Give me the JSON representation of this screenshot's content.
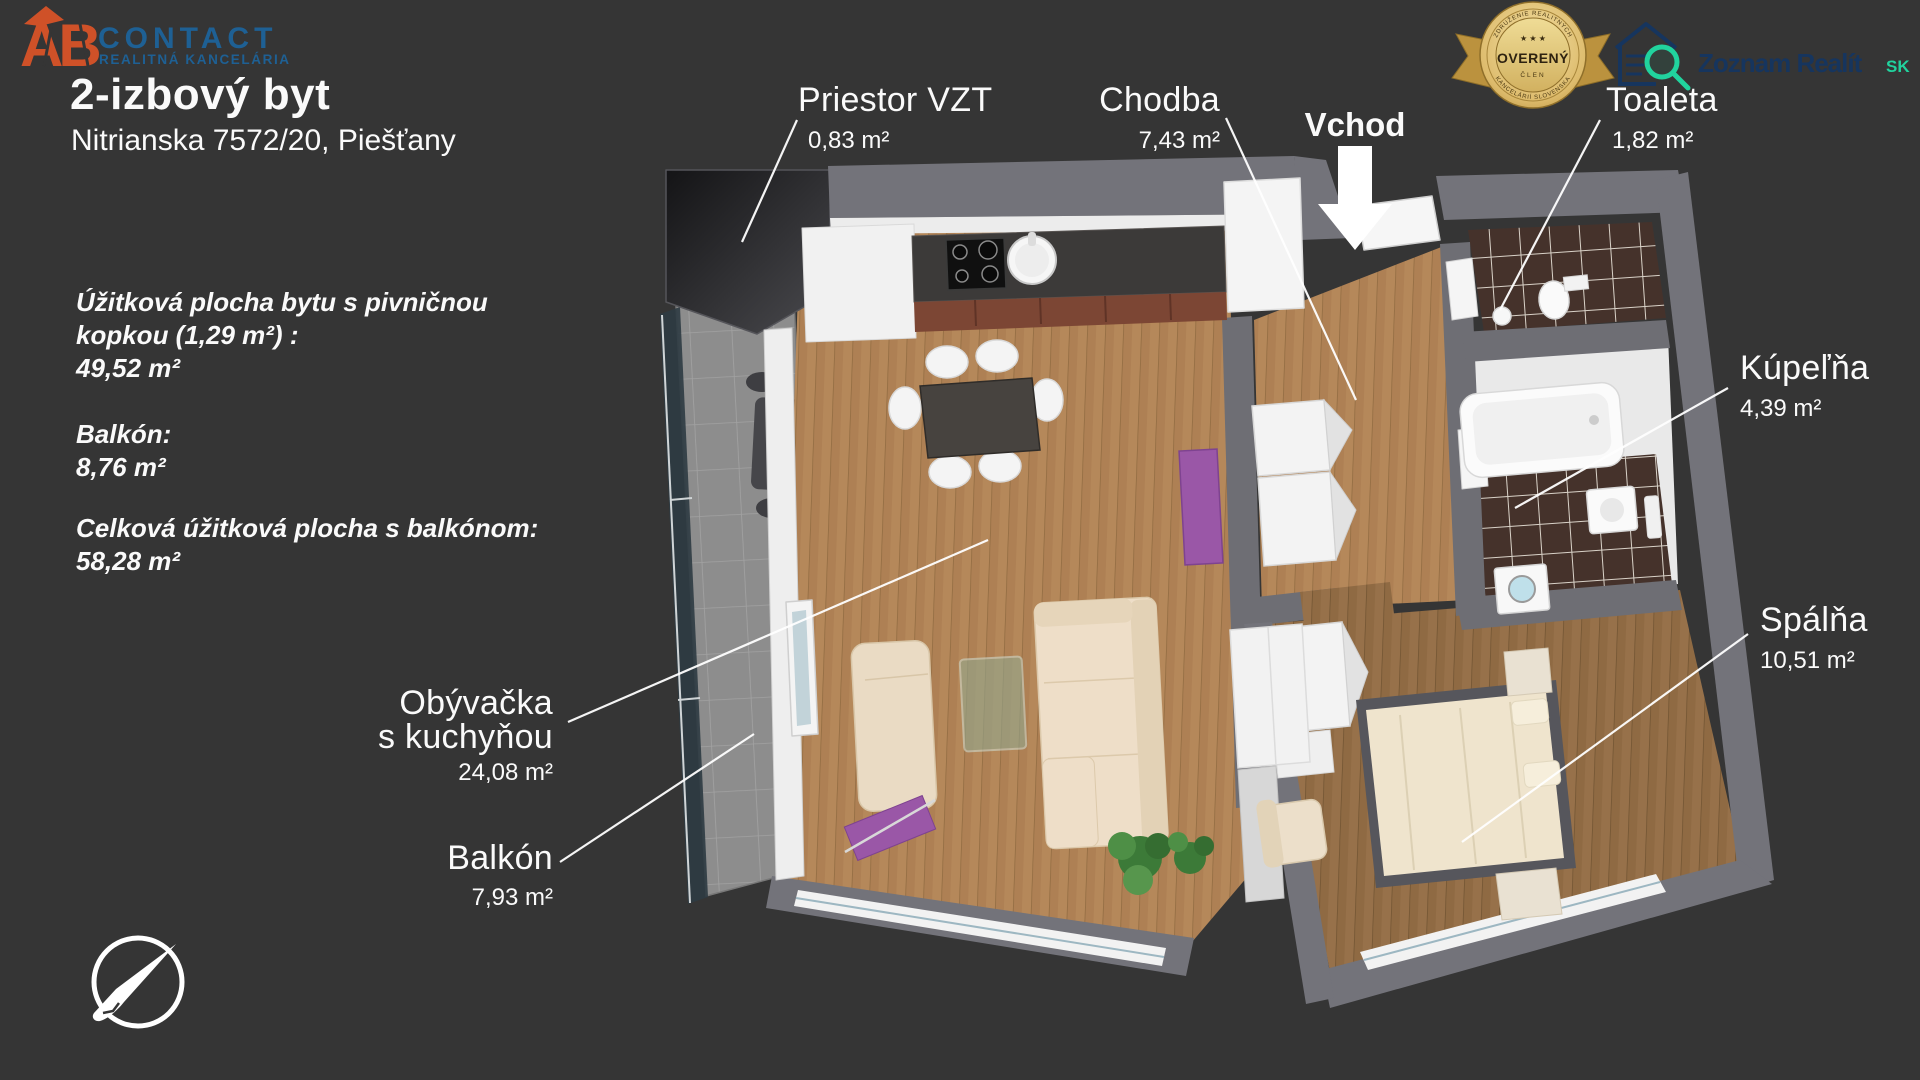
{
  "header": {
    "title": "2-izbový byt",
    "address": "Nitrianska 7572/20, Piešťany"
  },
  "branding": {
    "ab": {
      "monogram": "AB",
      "name": "CONTACT",
      "tagline": "REALITNÁ KANCELÁRIA",
      "orange": "#cf5128",
      "blue": "#1e6094"
    },
    "badge": {
      "arc_top": "ZDRUŽENIE REALITNÝCH",
      "arc_bottom": "KANCELÁRIÍ SLOVENSKA",
      "stars": "★ ★ ★",
      "title": "OVERENÝ",
      "member": "ČLEN",
      "gold": "#d4b05a"
    },
    "portal": {
      "name": "Zoznam Realít",
      "suffix": "SK",
      "navy": "#16355e",
      "teal": "#21d39e"
    }
  },
  "summary": [
    {
      "label": "Úžitková plocha bytu s pivničnou kopkou (1,29 m²) :",
      "value": "49,52 m²"
    },
    {
      "label": "Balkón:",
      "value": "8,76 m²"
    },
    {
      "label": "Celková úžitková plocha s balkónom:",
      "value": "58,28 m²"
    }
  ],
  "rooms": {
    "vzt": {
      "name": "Priestor VZT",
      "area": "0,83 m²"
    },
    "chodba": {
      "name": "Chodba",
      "area": "7,43 m²"
    },
    "toaleta": {
      "name": "Toaleta",
      "area": "1,82 m²"
    },
    "kupelna": {
      "name": "Kúpeľňa",
      "area": "4,39 m²"
    },
    "spalna": {
      "name": "Spálňa",
      "area": "10,51 m²"
    },
    "obyvacka": {
      "name_line1": "Obývačka",
      "name_line2": "s kuchyňou",
      "area": "24,08 m²"
    },
    "balkon": {
      "name": "Balkón",
      "area": "7,93 m²"
    }
  },
  "entrance": {
    "label": "Vchod"
  },
  "colors": {
    "background": "#353535",
    "wall_gray": "#73737a",
    "floor_wood": "#b5885a",
    "bedroom_wood": "#97714a",
    "tile_dark": "#45322b",
    "balcony_tile": "#8d8d8d",
    "furniture_purple": "#9a57a7"
  }
}
